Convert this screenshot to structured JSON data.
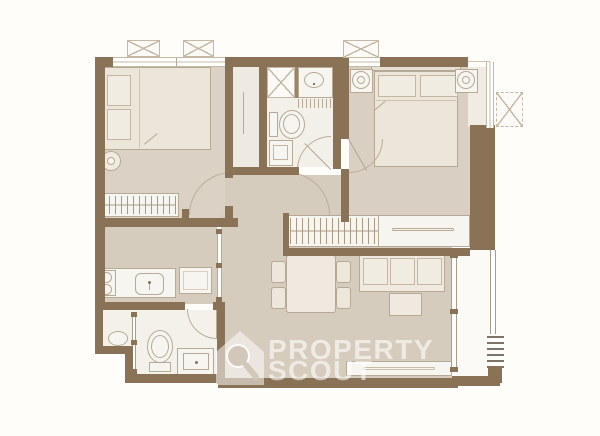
{
  "watermark": {
    "line1": "PROPERTY",
    "line2": "SCOUT",
    "logo": "house-with-magnifying-glass"
  },
  "palette": {
    "background": "#fefdfa",
    "wall": "#8a7256",
    "floor_main": "#d6ccbe",
    "floor_bedroom2": "#dbd2c5",
    "floor_master": "#d9cfc2",
    "floor_bath": "#f3f0ea",
    "floor_balcony": "#fbfaf7",
    "furniture_fill": "#ece6db",
    "furniture_stroke": "#b6a995",
    "window_line": "#c6b9a4",
    "watermark_color": "rgba(255,255,255,0.58)"
  },
  "plan": {
    "type": "apartment-floor-plan",
    "rooms": [
      {
        "name": "bedroom-2",
        "furniture": [
          "double-bed",
          "two-pillows",
          "bedside-plant",
          "wardrobe-with-hangers",
          "built-in-closet"
        ]
      },
      {
        "name": "bathroom-1",
        "furniture": [
          "shower",
          "washbasin",
          "toilet",
          "washing-machine",
          "swing-door"
        ]
      },
      {
        "name": "master-bedroom",
        "furniture": [
          "double-bed",
          "two-pillows",
          "headboard",
          "nightstand-left",
          "nightstand-right",
          "swing-door"
        ]
      },
      {
        "name": "entry-hall",
        "furniture": [
          "built-in-wardrobe",
          "dresser",
          "swing-door-left",
          "swing-door-right"
        ]
      },
      {
        "name": "kitchen",
        "furniture": [
          "two-burner-cooktop",
          "counter-with-sink",
          "refrigerator",
          "glass-partition"
        ]
      },
      {
        "name": "living-dining",
        "furniture": [
          "dining-table",
          "four-chairs",
          "three-seat-sofa",
          "coffee-table",
          "tv-console"
        ]
      },
      {
        "name": "bathroom-2",
        "furniture": [
          "toilet",
          "vanity-washbasin",
          "shower-compartment",
          "sliding-partition",
          "swing-door"
        ]
      },
      {
        "name": "balcony",
        "furniture": [
          "sliding-glass-door",
          "railing",
          "louver-vent"
        ]
      }
    ],
    "exterior_units": [
      "ac-condenser-1",
      "ac-condenser-2",
      "ac-condenser-3",
      "ac-condenser-4"
    ]
  }
}
